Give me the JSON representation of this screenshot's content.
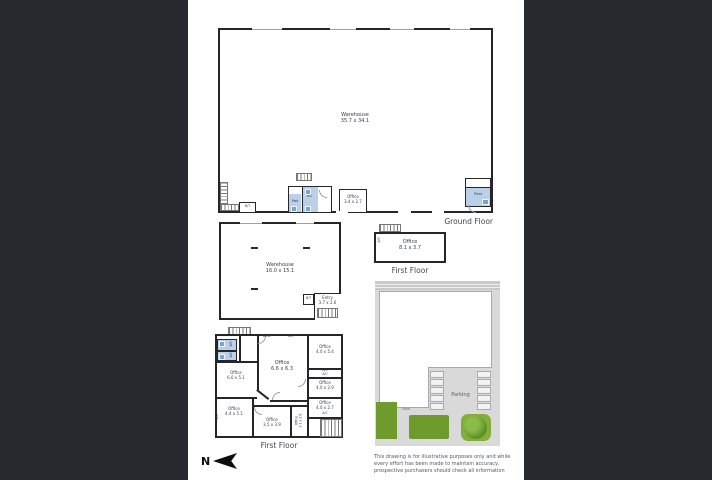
{
  "ground_floor": {
    "section_label": "Ground Floor",
    "warehouse": {
      "name": "Warehouse",
      "dims": "35.7 x 34.1"
    },
    "office": {
      "name": "Office",
      "dims": "3.4 x 2.7"
    },
    "bt": "B/T",
    "pwd": "Pwd",
    "wc": "WC",
    "plant": "Plant"
  },
  "mid_warehouse": {
    "name": "Warehouse",
    "dims": "16.0 x 15.1",
    "entry": {
      "name": "Entry",
      "dims": "3.7 x 2.6"
    },
    "bt": "B/T"
  },
  "first_floor_right": {
    "section_label": "First Floor",
    "office": {
      "name": "Office",
      "dims": "8.1 x 3.7"
    },
    "ac": "A/C"
  },
  "first_floor_left": {
    "section_label": "First Floor",
    "desk": "Desk",
    "ac": "A/C",
    "wc": "WC",
    "offices": {
      "o60": {
        "name": "Office",
        "dims": "6.0 x 5.1"
      },
      "o66": {
        "name": "Office",
        "dims": "6.6 x 6.3"
      },
      "o54": {
        "name": "Office",
        "dims": "4.0 x 5.4"
      },
      "o29": {
        "name": "Office",
        "dims": "4.0 x 2.9"
      },
      "o27": {
        "name": "Office",
        "dims": "4.0 x 2.7"
      },
      "o44": {
        "name": "Office",
        "dims": "4.4 x 5.1"
      },
      "o35": {
        "name": "Office",
        "dims": "3.5 x 3.9"
      },
      "o31": {
        "name": "Office",
        "dims": "3.1 x 2.6"
      }
    }
  },
  "site_plan": {
    "parking": "Parking",
    "shed": "Shed"
  },
  "compass": {
    "label": "N"
  },
  "disclaimer": {
    "line1": "This drawing is for illustrative purposes only and while",
    "line2": "every effort has been made to maintain accuracy,",
    "line3": "prospective purchasers should check all information"
  },
  "colors": {
    "page_bg": "#26292e",
    "paper": "#ffffff",
    "wall": "#26262a",
    "wet_area_blue": "#b9d0e8",
    "site_gray": "#d9d9d9",
    "landscape_green": "#6f9b2d",
    "tree_green": "#578f28"
  }
}
